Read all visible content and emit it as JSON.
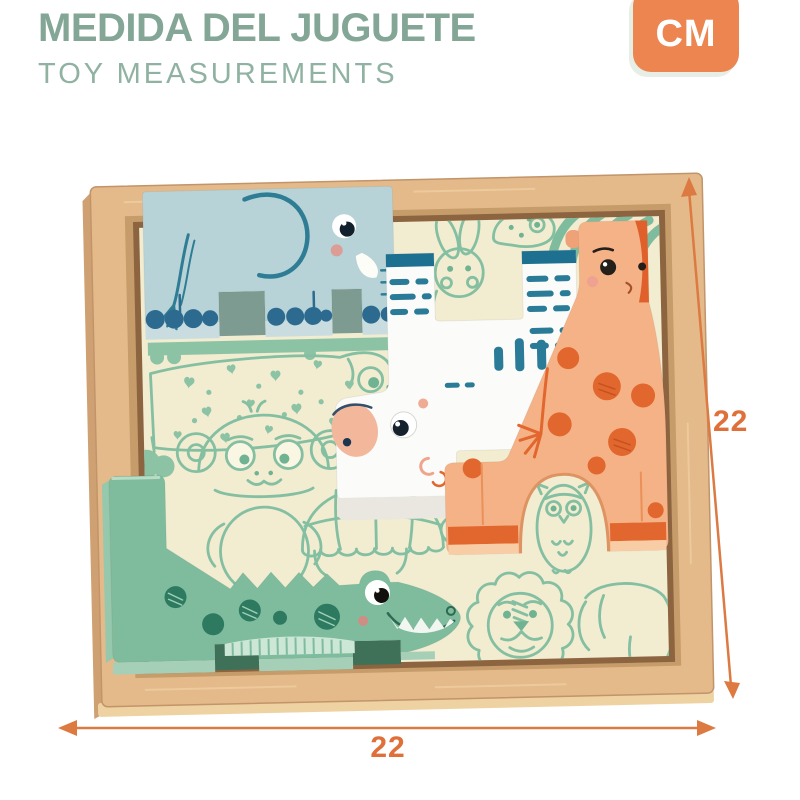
{
  "header": {
    "title": "MEDIDA DEL JUGUETE",
    "subtitle": "TOY MEASUREMENTS",
    "unit_badge": "CM"
  },
  "measurements": {
    "width_cm": "22",
    "height_cm": "22"
  },
  "colors": {
    "accent-orange": "#ec8550",
    "dim-orange": "#dc7a42",
    "title-green": "#84a696",
    "subtitle-green": "#90b2a2",
    "wood": "#e4ba8a",
    "wood-light": "#eed2a2",
    "wood-dark": "#8d6440",
    "board-cream": "#f2ecd1",
    "print-green": "#84bfa2",
    "elephant-blue": "#b7d3d7",
    "elephant-teal": "#2f7d94",
    "zebra-white": "#fbfbf9",
    "zebra-teal": "#2a7b98",
    "giraffe-peach": "#f5b286",
    "giraffe-orange": "#e2672f",
    "croc-green": "#7ebc9d",
    "croc-dark": "#2e7a61",
    "blush-pink": "#efa192"
  },
  "product": {
    "description": "Wooden animal block puzzle in tray",
    "pieces": [
      "elephant",
      "zebra",
      "giraffe",
      "crocodile"
    ],
    "board_prints": [
      "dog with hearts",
      "rabbit",
      "chameleon",
      "zebra stripes",
      "monkey",
      "turtle",
      "owl",
      "lion",
      "elephant outline",
      "grass band",
      "bushes"
    ]
  }
}
